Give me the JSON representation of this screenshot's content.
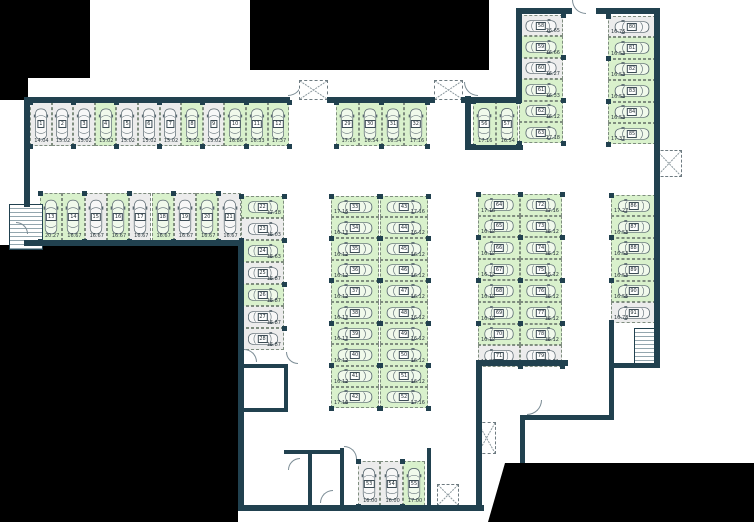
{
  "canvas": {
    "width": 754,
    "height": 522
  },
  "colors": {
    "wall": "#21414f",
    "stall_green": "#d9f1cc",
    "stall_gray": "#ececec",
    "void_black": "#000000",
    "car_outline": "#57666e"
  },
  "groups": [
    {
      "name": "row-top-left",
      "orient": "up",
      "x": 30,
      "y": 102,
      "w": 21.6,
      "h": 44,
      "stalls": [
        {
          "n": "1",
          "m": "14.04",
          "c": "w"
        },
        {
          "n": "2",
          "m": "15.02",
          "c": "w"
        },
        {
          "n": "3",
          "m": "15.02",
          "c": "w"
        },
        {
          "n": "4",
          "m": "15.02",
          "c": "g"
        },
        {
          "n": "5",
          "m": "15.02",
          "c": "w"
        },
        {
          "n": "6",
          "m": "15.02",
          "c": "w"
        },
        {
          "n": "7",
          "m": "15.02",
          "c": "w"
        },
        {
          "n": "8",
          "m": "15.02",
          "c": "g"
        },
        {
          "n": "9",
          "m": "15.02",
          "c": "w"
        },
        {
          "n": "10",
          "m": "16.86",
          "c": "g"
        },
        {
          "n": "11",
          "m": "16.33",
          "c": "g"
        },
        {
          "n": "12",
          "m": "17.37",
          "c": "g"
        }
      ]
    },
    {
      "name": "row-second-left",
      "orient": "up",
      "x": 40,
      "y": 193,
      "w": 22.3,
      "h": 48,
      "stalls": [
        {
          "n": "13",
          "m": "20.27",
          "c": "g"
        },
        {
          "n": "14",
          "m": "16.67",
          "c": "g"
        },
        {
          "n": "15",
          "m": "16.67",
          "c": "w"
        },
        {
          "n": "16",
          "m": "16.67",
          "c": "g"
        },
        {
          "n": "17",
          "m": "16.67",
          "c": "w"
        },
        {
          "n": "18",
          "m": "16.67",
          "c": "g"
        },
        {
          "n": "19",
          "m": "16.67",
          "c": "w"
        },
        {
          "n": "20",
          "m": "16.67",
          "c": "g"
        },
        {
          "n": "21",
          "m": "16.67",
          "c": "w"
        }
      ]
    },
    {
      "name": "column-left-mid",
      "orient": "right",
      "x": 241,
      "y": 196,
      "w": 43,
      "h": 22,
      "stalls": [
        {
          "n": "22",
          "m": "17.18",
          "c": "g"
        },
        {
          "n": "23",
          "m": "16.03",
          "c": "w"
        },
        {
          "n": "24",
          "m": "16.63",
          "c": "g"
        },
        {
          "n": "25",
          "m": "16.87",
          "c": "w"
        },
        {
          "n": "26",
          "m": "16.87",
          "c": "g"
        },
        {
          "n": "27",
          "m": "16.87",
          "c": "w"
        },
        {
          "n": "28",
          "m": "16.87",
          "c": "w"
        }
      ]
    },
    {
      "name": "row-top-middle",
      "orient": "up",
      "x": 336,
      "y": 102,
      "w": 22.8,
      "h": 44,
      "stalls": [
        {
          "n": "29",
          "m": "17.16",
          "c": "g"
        },
        {
          "n": "30",
          "m": "16.54",
          "c": "g"
        },
        {
          "n": "31",
          "m": "16.54",
          "c": "g"
        },
        {
          "n": "32",
          "m": "17.16",
          "c": "g"
        }
      ]
    },
    {
      "name": "middle-column-west",
      "orient": "left",
      "x": 331,
      "y": 196,
      "w": 48,
      "h": 21.2,
      "stalls": [
        {
          "n": "33",
          "m": "17.16",
          "c": "g"
        },
        {
          "n": "34",
          "m": "16.12",
          "c": "g"
        },
        {
          "n": "35",
          "m": "16.12",
          "c": "g"
        },
        {
          "n": "36",
          "m": "16.12",
          "c": "g"
        },
        {
          "n": "37",
          "m": "16.12",
          "c": "g"
        },
        {
          "n": "38",
          "m": "16.12",
          "c": "g"
        },
        {
          "n": "39",
          "m": "16.12",
          "c": "g"
        },
        {
          "n": "40",
          "m": "16.12",
          "c": "g"
        },
        {
          "n": "41",
          "m": "16.12",
          "c": "g"
        },
        {
          "n": "42",
          "m": "17.16",
          "c": "g"
        }
      ]
    },
    {
      "name": "middle-column-east",
      "orient": "right",
      "x": 380,
      "y": 196,
      "w": 48,
      "h": 21.2,
      "stalls": [
        {
          "n": "43",
          "m": "17.16",
          "c": "g"
        },
        {
          "n": "44",
          "m": "16.12",
          "c": "g"
        },
        {
          "n": "45",
          "m": "16.12",
          "c": "g"
        },
        {
          "n": "46",
          "m": "16.12",
          "c": "g"
        },
        {
          "n": "47",
          "m": "16.12",
          "c": "g"
        },
        {
          "n": "48",
          "m": "16.12",
          "c": "g"
        },
        {
          "n": "49",
          "m": "16.12",
          "c": "g"
        },
        {
          "n": "50",
          "m": "16.12",
          "c": "g"
        },
        {
          "n": "51",
          "m": "16.12",
          "c": "g"
        },
        {
          "n": "52",
          "m": "17.16",
          "c": "g"
        }
      ]
    },
    {
      "name": "row-bottom-middle",
      "orient": "up",
      "x": 358,
      "y": 461,
      "w": 22.4,
      "h": 45,
      "stalls": [
        {
          "n": "53",
          "m": "16.00",
          "c": "w"
        },
        {
          "n": "54",
          "m": "16.00",
          "c": "w"
        },
        {
          "n": "55",
          "m": "17.00",
          "c": "g"
        }
      ]
    },
    {
      "name": "pair-top-right",
      "orient": "up",
      "x": 473,
      "y": 101,
      "w": 22.5,
      "h": 45,
      "stalls": [
        {
          "n": "56",
          "m": "17.16",
          "c": "g"
        },
        {
          "n": "57",
          "m": "16.54",
          "c": "g"
        }
      ]
    },
    {
      "name": "column-58",
      "orient": "right",
      "x": 519,
      "y": 15,
      "w": 44,
      "h": 21.4,
      "stalls": [
        {
          "n": "58",
          "m": "16.65",
          "c": "w"
        },
        {
          "n": "59",
          "m": "16.66",
          "c": "g"
        },
        {
          "n": "60",
          "m": "16.27",
          "c": "w"
        },
        {
          "n": "61",
          "m": "16.33",
          "c": "g"
        },
        {
          "n": "62",
          "m": "16.12",
          "c": "g"
        },
        {
          "n": "63",
          "m": "17.18",
          "c": "g"
        }
      ]
    },
    {
      "name": "column-80",
      "orient": "left",
      "x": 608,
      "y": 16,
      "w": 48,
      "h": 21.4,
      "stalls": [
        {
          "n": "80",
          "m": "16.76",
          "c": "w"
        },
        {
          "n": "81",
          "m": "16.53",
          "c": "g"
        },
        {
          "n": "82",
          "m": "16.53",
          "c": "g"
        },
        {
          "n": "83",
          "m": "16.53",
          "c": "g"
        },
        {
          "n": "84",
          "m": "16.53",
          "c": "g"
        },
        {
          "n": "85",
          "m": "17.37",
          "c": "g"
        }
      ]
    },
    {
      "name": "column-86",
      "orient": "left",
      "x": 611,
      "y": 195,
      "w": 45,
      "h": 21.4,
      "stalls": [
        {
          "n": "86",
          "m": "17.27",
          "c": "g"
        },
        {
          "n": "87",
          "m": "16.53",
          "c": "g"
        },
        {
          "n": "88",
          "m": "16.53",
          "c": "g"
        },
        {
          "n": "89",
          "m": "16.53",
          "c": "g"
        },
        {
          "n": "90",
          "m": "16.55",
          "c": "g"
        },
        {
          "n": "91",
          "m": "16.78",
          "c": "w"
        }
      ]
    },
    {
      "name": "right-column-west",
      "orient": "left",
      "x": 478,
      "y": 194,
      "w": 42,
      "h": 21.6,
      "stalls": [
        {
          "n": "64",
          "m": "17.16",
          "c": "g"
        },
        {
          "n": "65",
          "m": "16.12",
          "c": "g"
        },
        {
          "n": "66",
          "m": "16.12",
          "c": "g"
        },
        {
          "n": "67",
          "m": "16.12",
          "c": "g"
        },
        {
          "n": "68",
          "m": "16.12",
          "c": "g"
        },
        {
          "n": "69",
          "m": "16.12",
          "c": "g"
        },
        {
          "n": "70",
          "m": "16.12",
          "c": "g"
        },
        {
          "n": "71",
          "m": "16.81",
          "c": "w"
        }
      ]
    },
    {
      "name": "right-column-east",
      "orient": "right",
      "x": 520,
      "y": 194,
      "w": 42,
      "h": 21.6,
      "stalls": [
        {
          "n": "72",
          "m": "17.16",
          "c": "g"
        },
        {
          "n": "73",
          "m": "16.12",
          "c": "g"
        },
        {
          "n": "74",
          "m": "16.12",
          "c": "g"
        },
        {
          "n": "75",
          "m": "16.12",
          "c": "g"
        },
        {
          "n": "76",
          "m": "16.12",
          "c": "g"
        },
        {
          "n": "77",
          "m": "16.12",
          "c": "g"
        },
        {
          "n": "78",
          "m": "16.12",
          "c": "g"
        },
        {
          "n": "79",
          "m": "16.81",
          "c": "w"
        }
      ]
    }
  ],
  "voids": [
    {
      "x": 0,
      "y": 0,
      "w": 90,
      "h": 78
    },
    {
      "x": 0,
      "y": 0,
      "w": 28,
      "h": 100
    },
    {
      "x": 250,
      "y": 0,
      "w": 239,
      "h": 70
    },
    {
      "x": 0,
      "y": 245,
      "w": 238,
      "h": 277
    },
    {
      "x": 483,
      "y": 461,
      "w": 271,
      "h": 61,
      "clip": "polygon(22px 2px, 271px 2px, 271px 61px, 5px 61px)"
    }
  ],
  "walls": [
    [
      24,
      97,
      266,
      6
    ],
    [
      327,
      97,
      108,
      6
    ],
    [
      461,
      97,
      60,
      6
    ],
    [
      24,
      97,
      6,
      110
    ],
    [
      24,
      240,
      218,
      6
    ],
    [
      238,
      240,
      6,
      271
    ],
    [
      238,
      505,
      246,
      6
    ],
    [
      476,
      360,
      6,
      151
    ],
    [
      476,
      360,
      92,
      6
    ],
    [
      516,
      8,
      6,
      95
    ],
    [
      516,
      8,
      56,
      6
    ],
    [
      596,
      8,
      64,
      6
    ],
    [
      654,
      8,
      6,
      360
    ],
    [
      609,
      320,
      5,
      48
    ],
    [
      609,
      363,
      51,
      5
    ],
    [
      609,
      363,
      5,
      57
    ],
    [
      520,
      415,
      94,
      5
    ],
    [
      520,
      415,
      5,
      48
    ],
    [
      465,
      96,
      6,
      54
    ],
    [
      465,
      145,
      58,
      5
    ],
    [
      242,
      364,
      44,
      4
    ],
    [
      284,
      364,
      4,
      48
    ],
    [
      242,
      408,
      46,
      4
    ],
    [
      284,
      450,
      60,
      4
    ],
    [
      308,
      450,
      4,
      58
    ],
    [
      340,
      448,
      4,
      60
    ],
    [
      427,
      448,
      4,
      60
    ]
  ],
  "stairs": [
    {
      "x": 9,
      "y": 204,
      "w": 32,
      "h": 44
    },
    {
      "x": 634,
      "y": 328,
      "w": 24,
      "h": 38
    }
  ],
  "doors": [
    {
      "x": 288,
      "y": 82,
      "r": 14,
      "c": "br"
    },
    {
      "x": 464,
      "y": 82,
      "r": 14,
      "c": "bl"
    },
    {
      "x": 572,
      "y": 0,
      "r": 14,
      "c": "bl"
    },
    {
      "x": 344,
      "y": 446,
      "r": 13,
      "c": "tr"
    },
    {
      "x": 244,
      "y": 349,
      "r": 13,
      "c": "tr"
    },
    {
      "x": 527,
      "y": 400,
      "r": 15,
      "c": "br"
    },
    {
      "x": 286,
      "y": 352,
      "r": 12,
      "c": "bl"
    },
    {
      "x": 288,
      "y": 458,
      "r": 12,
      "c": "tl"
    },
    {
      "x": 320,
      "y": 490,
      "r": 13,
      "c": "tl"
    },
    {
      "x": 16,
      "y": 222,
      "r": 12,
      "c": "tr"
    }
  ],
  "openings": [
    {
      "x": 299,
      "y": 80,
      "w": 29,
      "h": 20
    },
    {
      "x": 434,
      "y": 80,
      "w": 29,
      "h": 20
    },
    {
      "x": 477,
      "y": 422,
      "w": 19,
      "h": 32
    },
    {
      "x": 656,
      "y": 150,
      "w": 26,
      "h": 27
    },
    {
      "x": 437,
      "y": 484,
      "w": 22,
      "h": 22
    }
  ]
}
